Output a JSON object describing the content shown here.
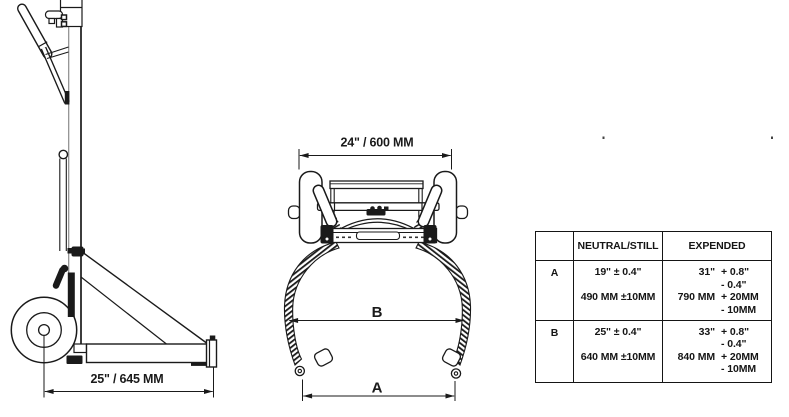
{
  "colors": {
    "ink": "#1a1a1a",
    "background": "#ffffff"
  },
  "side_view": {
    "base_width_label": "25\" / 645 MM"
  },
  "front_view": {
    "top_width_label": "24\" / 600 MM",
    "dim_b_label": "B",
    "dim_a_label": "A"
  },
  "spec_table": {
    "col_headers": {
      "neutral": "NEUTRAL/STILL",
      "expended": "EXPENDED"
    },
    "rows": [
      {
        "label": "A",
        "neutral_inches": "19\" ± 0.4\"",
        "neutral_mm": "490 MM ±10MM",
        "expended_inches": "31\"",
        "expended_inches_plus": "+ 0.8\"",
        "expended_inches_minus": "- 0.4\"",
        "expended_mm": "790 MM",
        "expended_mm_plus": "+ 20MM",
        "expended_mm_minus": "- 10MM"
      },
      {
        "label": "B",
        "neutral_inches": "25\" ± 0.4\"",
        "neutral_mm": "640 MM ±10MM",
        "expended_inches": "33\"",
        "expended_inches_plus": "+ 0.8\"",
        "expended_inches_minus": "- 0.4\"",
        "expended_mm": "840 MM",
        "expended_mm_plus": "+ 20MM",
        "expended_mm_minus": "- 10MM"
      }
    ]
  }
}
